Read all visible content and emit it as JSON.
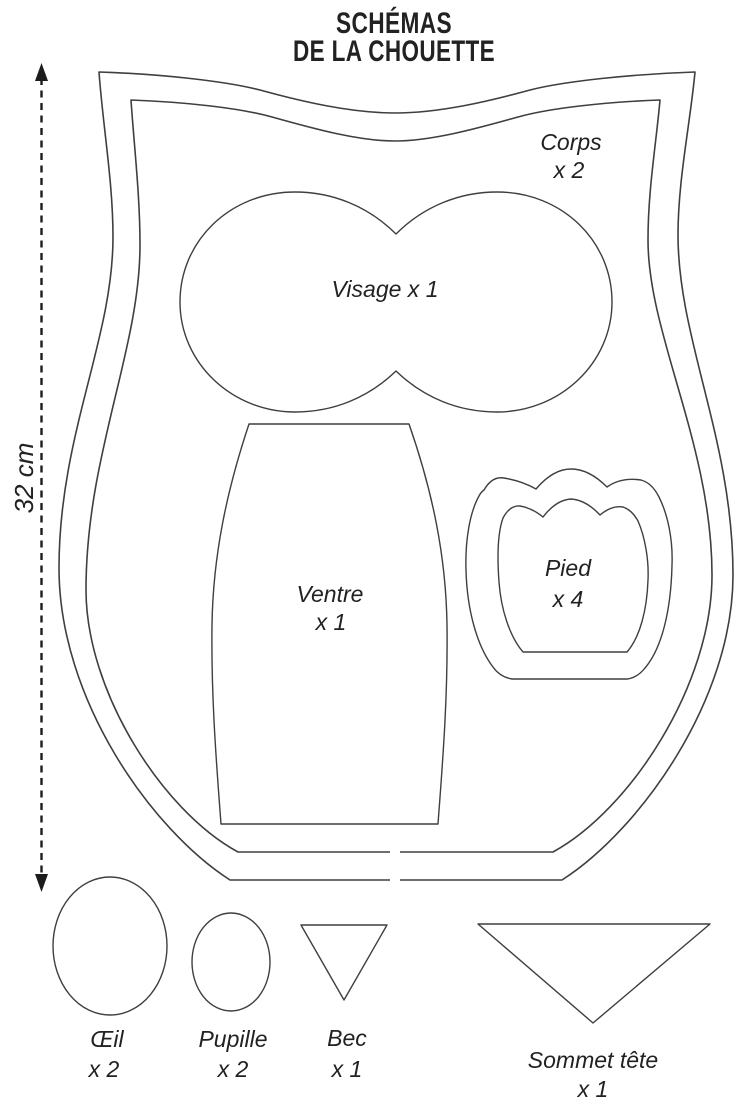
{
  "title": {
    "line1": "SCHÉMAS",
    "line2": "DE LA CHOUETTE"
  },
  "measurement": {
    "label": "32 cm"
  },
  "pieces": {
    "corps": {
      "name": "Corps",
      "qty": "x 2"
    },
    "visage": {
      "label": "Visage x 1"
    },
    "ventre": {
      "name": "Ventre",
      "qty": "x 1"
    },
    "pied": {
      "name": "Pied",
      "qty": "x 4"
    },
    "oeil": {
      "name": "Œil",
      "qty": "x 2"
    },
    "pupille": {
      "name": "Pupille",
      "qty": "x 2"
    },
    "bec": {
      "name": "Bec",
      "qty": "x 1"
    },
    "sommet_tete": {
      "name": "Sommet tête",
      "qty": "x 1"
    }
  },
  "colors": {
    "outline": "#3f3f3f",
    "text": "#222222",
    "background": "#ffffff"
  }
}
